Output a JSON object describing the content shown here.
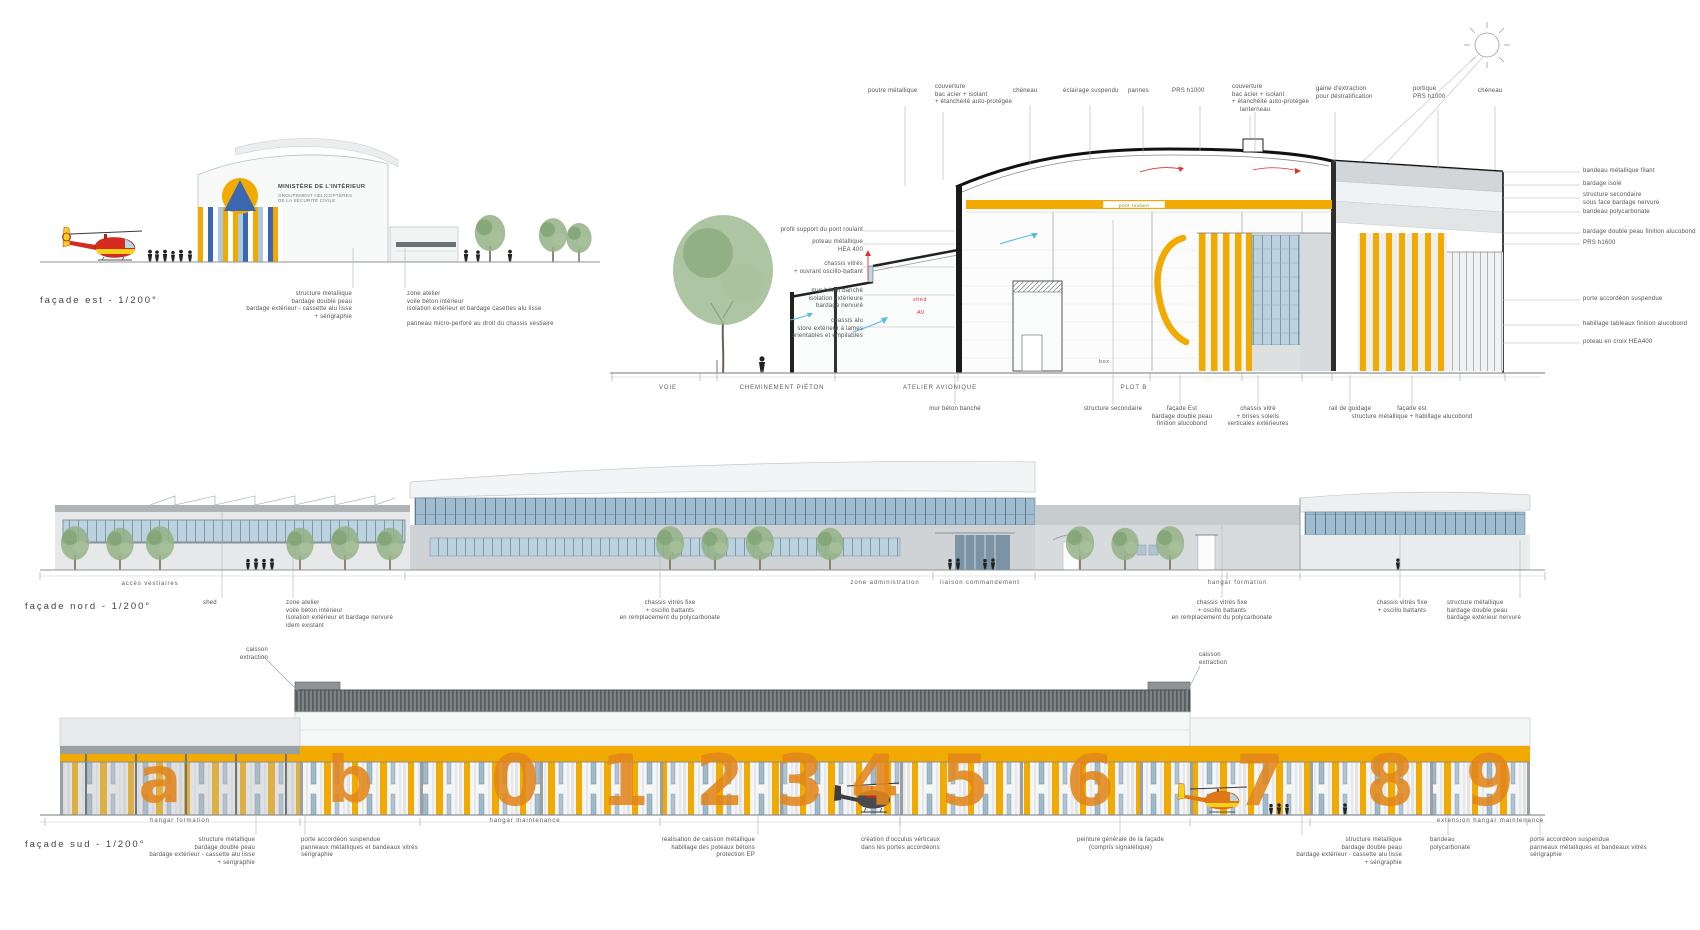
{
  "colors": {
    "accent_orange": "#F2A900",
    "door_digit_orange": "#E2861B",
    "logo_blue": "#3B66B0",
    "glazing_blue": "#9FB8CA",
    "annotation_red": "#E03030",
    "airflow_blue": "#58BCE4",
    "helicopter_red": "#D42B1E",
    "helicopter_yellow": "#F7D117"
  },
  "facade_est": {
    "title": "façade est - 1/200°",
    "sign": {
      "line1": "MINISTÈRE DE L'INTÉRIEUR",
      "line2": "GROUPEMENT HÉLICOPTÈRES\nDE LA SÉCURITÉ CIVILE"
    },
    "annotations": [
      "structure métallique\nbardage double peau\nbardage extérieur - cassette alu lisse\n+ sérigraphie",
      "zone atelier\nvoile béton intérieur\nisolation extérieur et bardage casettes alu lisse",
      "panneau micro-perforé au droit du chassis vestiaire"
    ]
  },
  "section": {
    "top_labels": [
      "poutre métallique",
      "couverture\nbac acier + isolant\n+ étanchéité auto-protégée",
      "chéneau",
      "éclairage suspendu",
      "pannes",
      "PRS h1000",
      "couverture\nbac acier + isolant\n+ étanchéité auto-protégée",
      "gaine d'extraction\npour déstratification",
      "portique\nPRS h1000",
      "chéneau"
    ],
    "left_labels": [
      "profil support du pont roulant",
      "poteau métallique\nHEA 400",
      "chassis vitrés\n+ ouvrant oscillo-battant",
      "mur béton banché\nisolation extérieure\nbardage nervuré",
      "chassis alu\nstore extérieur à lames\norientables et empilables"
    ],
    "right_labels": [
      "bandeau métallique filant",
      "bardage isolé",
      "structure secondaire\nsous face bardage nervuré",
      "bandeau polycarbonate",
      "bardage double peau finition alucobond",
      "PRS h1600",
      "porte accordéon suspendue",
      "habillage tableaux finition alucobond",
      "poteau en croix HEA400"
    ],
    "bottom_labels": [
      "mur béton banché",
      "structure secondaire",
      "façade Est\nbardage double peau\nfinition alucobond",
      "chassis vitré\n+ brises soleils\nverticales extérieures",
      "rail de guidage",
      "façade est\nstructure métallique + habillage alucobond"
    ],
    "ground_labels": [
      "VOIE",
      "CHEMINEMENT PIÉTON",
      "ATELIER AVIONIQUE",
      "PLOT B"
    ],
    "misc": {
      "lanterneau": "lanterneau",
      "pont_roulant": "pont roulant",
      "box": "box",
      "shed": "shed",
      "av": "AV"
    }
  },
  "facade_nord": {
    "title": "façade nord - 1/200°",
    "zone_labels": [
      "accès vestiaires",
      "zone administration",
      "liaison commandement",
      "hangar formation"
    ],
    "annotations": [
      "shed",
      "zone atelier\nvoile béton intérieur\nisolation extérieur et bardage nervuré\nidem existant",
      "chassis vitrés fixe\n+ oscillo battants\nen remplacement du polycarbonate",
      "chassis vitrés fixe\n+ oscillo battants\nen remplacement du polycarbonate",
      "chassis vitrés fixe\n+ oscillo battants",
      "structure métallique\nbardage double peau\nbardage extérieur nervuré"
    ]
  },
  "facade_sud": {
    "title": "façade sud - 1/200°",
    "caisson_label": "caisson\nextraction",
    "zone_labels": [
      "hangar formation",
      "hangar maintenance",
      "extension hangar maintenance"
    ],
    "door_marks": [
      "a",
      "b",
      "0",
      "1",
      "2",
      "3",
      "4",
      "5",
      "6",
      "7",
      "8",
      "9"
    ],
    "annotations": [
      "structure métallique\nbardage double peau\nbardage extérieur - cassette alu lisse\n+ sérigraphie",
      "porte accordéon suspendue\npanneaux métalliques et bandeaux vitrés\nsérigraphie",
      "réalisation de caisson métallique\nhabillage des poteaux bétons\nprotection EP",
      "création d'occulus vérticaux\ndans les portes accordéons",
      "peinture générale de la façade\n(compris signalétique)",
      "structure métallique\nbardage double peau\nbardage extérieur - cassette alu lisse\n+ sérigraphie",
      "bandeau\npolycarbonate",
      "porte accordéon suspendue\npanneaux métalliques et bandeaux vitrés\nsérigraphie"
    ]
  }
}
